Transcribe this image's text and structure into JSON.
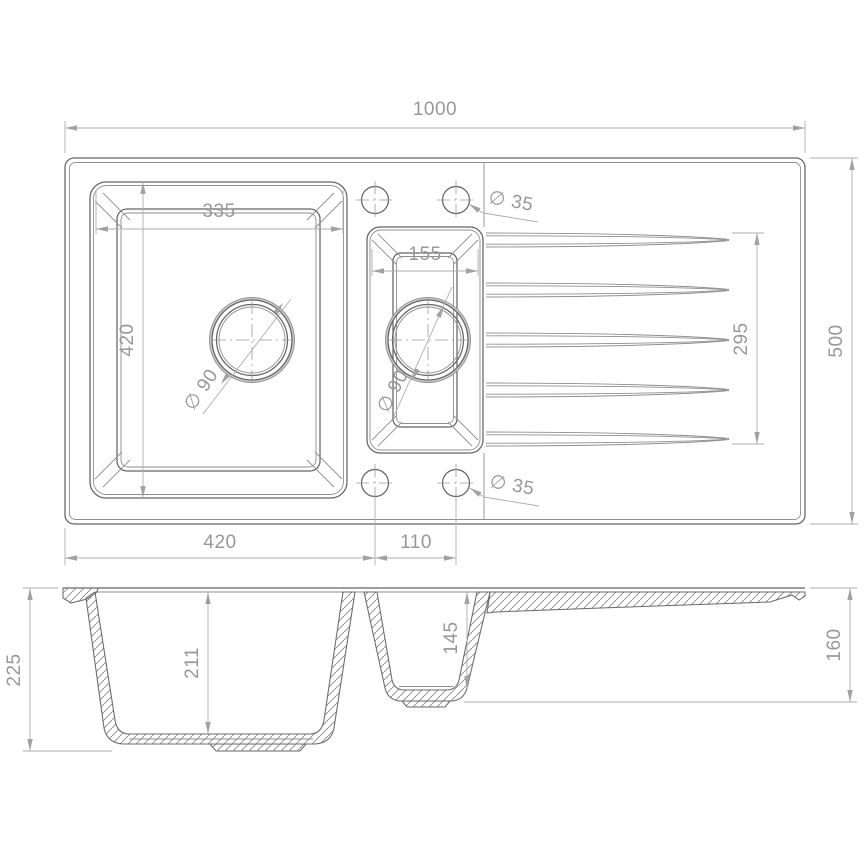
{
  "drawing": {
    "type": "technical-drawing",
    "subject": "1.5 bowl kitchen sink with drainer — plan and section views",
    "colors": {
      "background": "#ffffff",
      "outline": "#646464",
      "secondary_line": "#8f8f8f",
      "dimension_line": "#adadad",
      "dimension_text": "#989898"
    },
    "views": {
      "plan": {
        "dim_overall_width": "1000",
        "dim_overall_depth": "500",
        "dim_bowl1_width": "335",
        "dim_bowl1_length": "420",
        "dim_bowl2_width": "155",
        "dim_drainer_grooves": "295",
        "dim_tap_hole_top": "∅ 35",
        "dim_tap_hole_bottom": "∅ 35",
        "dim_bowl1_drain": "∅ 90",
        "dim_bowl2_drain": "∅ 90",
        "dim_edge_to_hole": "420",
        "dim_hole_spacing": "110"
      },
      "section": {
        "dim_total_height": "225",
        "dim_bowl1_depth": "211",
        "dim_bowl2_depth": "145",
        "dim_drainer_end_height": "160"
      }
    }
  }
}
